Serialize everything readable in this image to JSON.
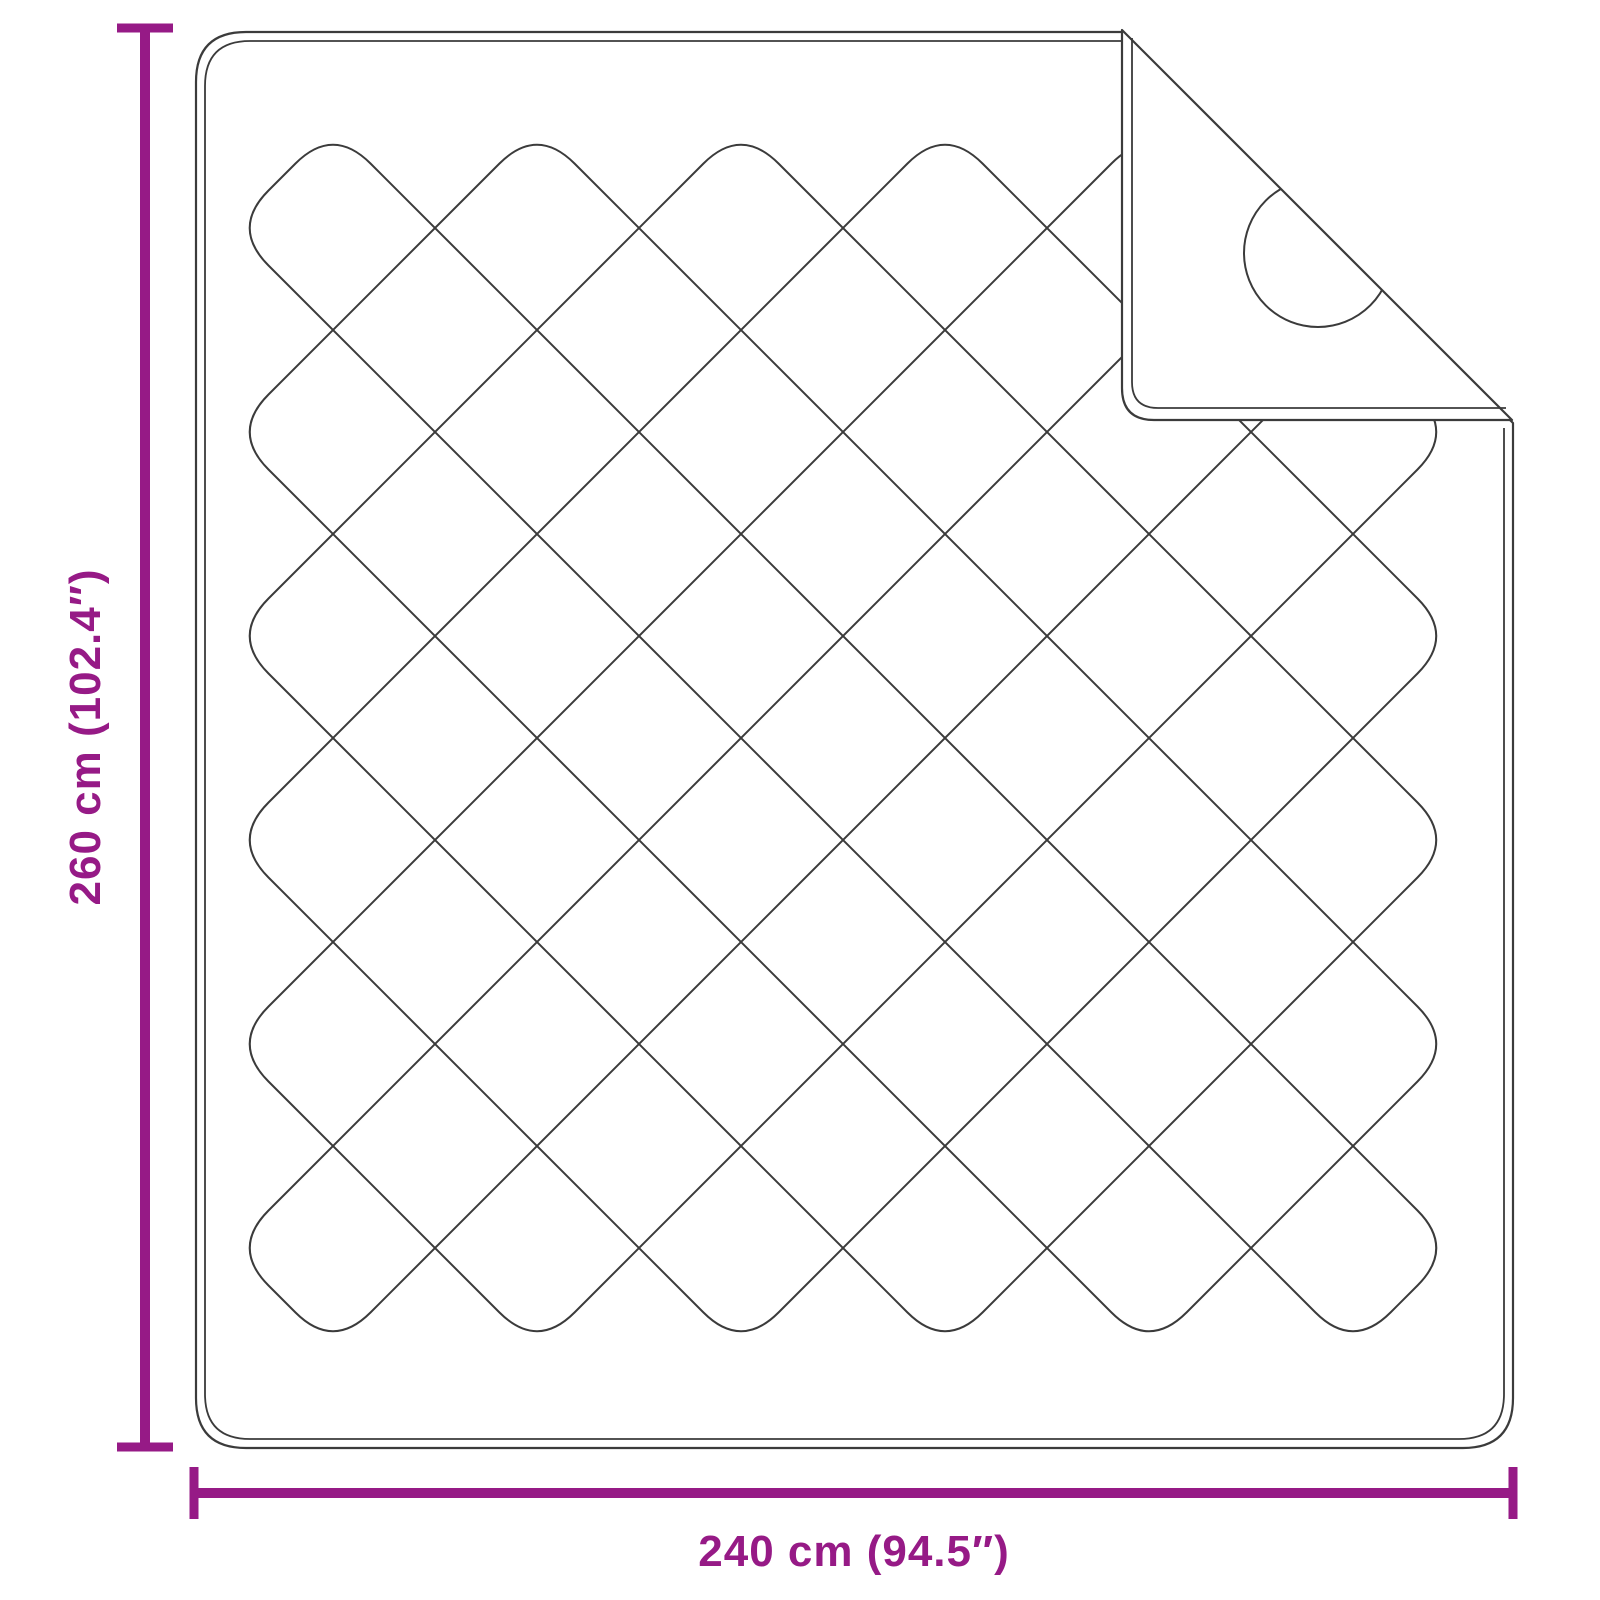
{
  "diagram": {
    "subject": "quilted-blanket-with-folded-corner",
    "dimensions": {
      "height_label": "260 cm (102.4″)",
      "width_label": "240 cm (94.5″)",
      "height_cm": 260,
      "height_inches": 102.4,
      "width_cm": 240,
      "width_inches": 94.5
    },
    "colors": {
      "accent": "#961A86",
      "line": "#3B3B3B",
      "background": "#FFFFFF"
    }
  }
}
